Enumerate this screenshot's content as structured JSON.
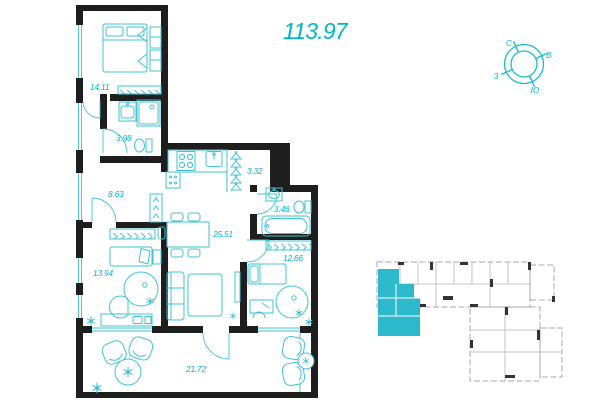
{
  "header": {
    "total_area": "113.97"
  },
  "floor_plan": {
    "rooms": [
      {
        "name": "bedroom",
        "area": "14.11"
      },
      {
        "name": "bathroom-1",
        "area": "3.98"
      },
      {
        "name": "hallway",
        "area": "8.63"
      },
      {
        "name": "wardrobe",
        "area": "3.32"
      },
      {
        "name": "kitchen-living-room",
        "area": "25.51"
      },
      {
        "name": "bathroom-2",
        "area": "3.46"
      },
      {
        "name": "bedroom-2",
        "area": "12.66"
      },
      {
        "name": "bedroom-3",
        "area": "13.94"
      },
      {
        "name": "terrace",
        "area": "21.72"
      }
    ]
  },
  "compass": {
    "north_label": "С",
    "east_label": "В",
    "south_label": "Ю",
    "west_label": "З"
  },
  "colors": {
    "accent": "#00b5ce",
    "furniture": "#3fc3d3",
    "walls": "#1e1e1e",
    "minimap_outline": "#a8a8a8",
    "minimap_highlight": "#2cb9cb"
  }
}
